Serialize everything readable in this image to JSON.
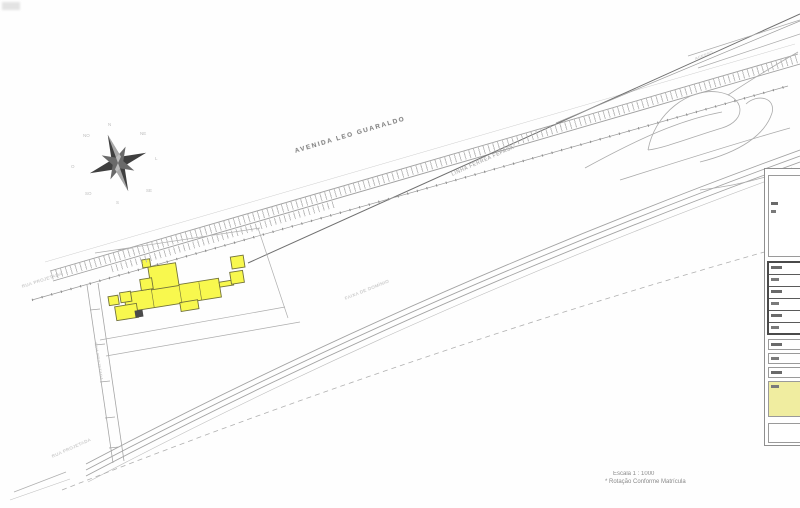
{
  "labels": {
    "avenue": "AVENIDA LEO GUARALDO",
    "railway": "LINHA FÉRREA FEPASA",
    "highway_note": "FAIXA DE DOMÍNIO",
    "street_left": "RUA PROJETADA",
    "street_bottom": "RUA PROJETADA",
    "street_vertical": "RUA PROJETADA",
    "access_ramp": "ACESSO"
  },
  "notes": {
    "scale": "Escala 1 : 1000",
    "deed": "* Rotação Conforme Matrícula"
  },
  "compass": {
    "n": "N",
    "ne": "NE",
    "e": "L",
    "se": "SE",
    "s": "S",
    "sw": "SO",
    "w": "O",
    "nw": "NO"
  },
  "colors": {
    "building_fill": "#f8f84e",
    "building_stroke": "#72723a",
    "panel_highlight": "#f0eda0",
    "line_gray": "#a8a8a8",
    "dark_line": "#6f6f6f"
  }
}
